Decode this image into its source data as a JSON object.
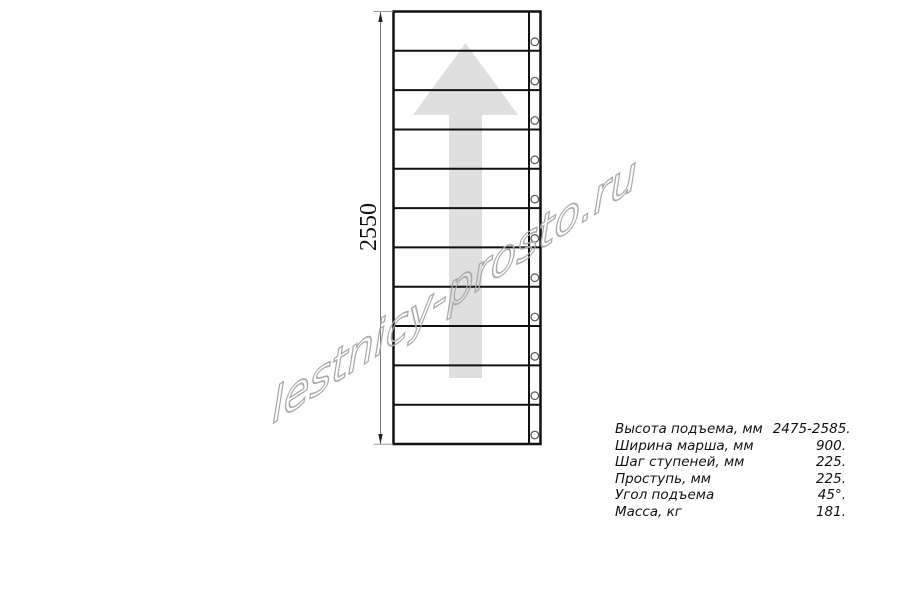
{
  "drawing": {
    "dimension_label": "2550",
    "steps": 11,
    "watermark": "lestnicy-prosto.ru",
    "colors": {
      "line": "#111111",
      "arrow": "#dfdfdf",
      "watermark": "#a9a9a9",
      "dimension": "#777777"
    }
  },
  "specs": {
    "rows": [
      {
        "label": "Высота подъема, мм",
        "value": "2475-2585."
      },
      {
        "label": "Ширина марша, мм",
        "value": "900."
      },
      {
        "label": "Шаг ступеней, мм",
        "value": "225."
      },
      {
        "label": "Проступь, мм",
        "value": "225."
      },
      {
        "label": "Угол подъема",
        "value": "45°."
      },
      {
        "label": "Масса, кг",
        "value": "181."
      }
    ]
  }
}
